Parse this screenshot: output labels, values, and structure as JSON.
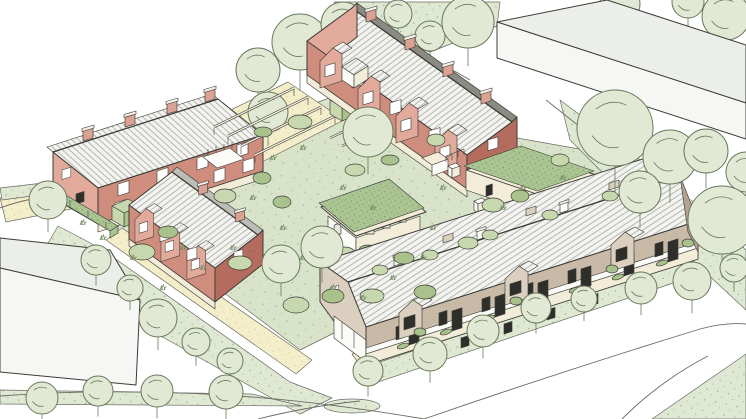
{
  "scene": {
    "title": "Courtyard housing development - hand-drawn axonometric site illustration",
    "style": "architectural sketch, pale watercolour palette, no text labels",
    "housing_rows": [
      {
        "id": "north-west-terrace",
        "material": "red brick",
        "units": 4,
        "chimneys": 4,
        "roof": "grey standing-seam pitched roof"
      },
      {
        "id": "west-mews-terrace",
        "material": "red brick",
        "units": 3,
        "chimneys": 2,
        "roof": "pitched roof with gabled bays, dark terracotta end gable"
      },
      {
        "id": "north-east-terrace",
        "material": "red brick",
        "units": 4,
        "chimneys": 4,
        "roof": "pitched roof with gabled bays, dark terracotta end gable"
      },
      {
        "id": "south-terrace",
        "material": "buff brick",
        "units": 7,
        "chimneys": 4,
        "roof": "long pitched roof, balconies with planters facing the street"
      }
    ],
    "courtyard_features": [
      "central pavilion with sedum green roof and arched openings",
      "timber pergola walk",
      "green-roof link building",
      "clipped hedge cubes",
      "green-roof boundary store",
      "bin and cycle stores",
      "white bollards",
      "shared gardens, shrubs and winding paths"
    ],
    "context": {
      "neighbouring_buildings": 2,
      "street_trees": 13,
      "garden_trees": 9,
      "large_trees_right_cluster": 6,
      "roads": "white streets wrapping the site with grass verges"
    }
  },
  "palette": {
    "paper": "#ffffff",
    "ink": "#3c3c37",
    "inkSoft": "#6b6b64",
    "treeFill": "#e1e9d5",
    "treeLine": "#68795c",
    "grassTuft": "#7a8f68",
    "verge": "#dfe8d2",
    "vergeDot": "#9cab8b",
    "grass": "#d8e3c9",
    "grassDot": "#a3b291",
    "bush": "#c7d8af",
    "bushDark": "#a9c28c",
    "path": "#f4eecb",
    "pathDot": "#c0ba92",
    "sedum": "#abc493",
    "sedumDot": "#7c9a63",
    "roofLight": "#f3f3f0",
    "roofStripe": "#a6a6a1",
    "roofDark": "#8b8b84",
    "roofMid": "#bdbdb7",
    "redLight": "#e2aa9b",
    "red": "#cf8d7d",
    "redDark": "#b46c5e",
    "redStreak": "#9b5b4e",
    "chimneyRed": "#dba193",
    "capWhite": "#f6f1ea",
    "beigeLight": "#dbcfbf",
    "beige": "#c9baa8",
    "beigeDark": "#b3a390",
    "cream": "#f2ecd9",
    "white": "#fbfbf7",
    "frame": "#2e2e2a",
    "glass": "#ffffff",
    "archShade": "#e8e7dd",
    "contextFace": "#f6f7f4",
    "contextRoof": "#eceeea"
  }
}
